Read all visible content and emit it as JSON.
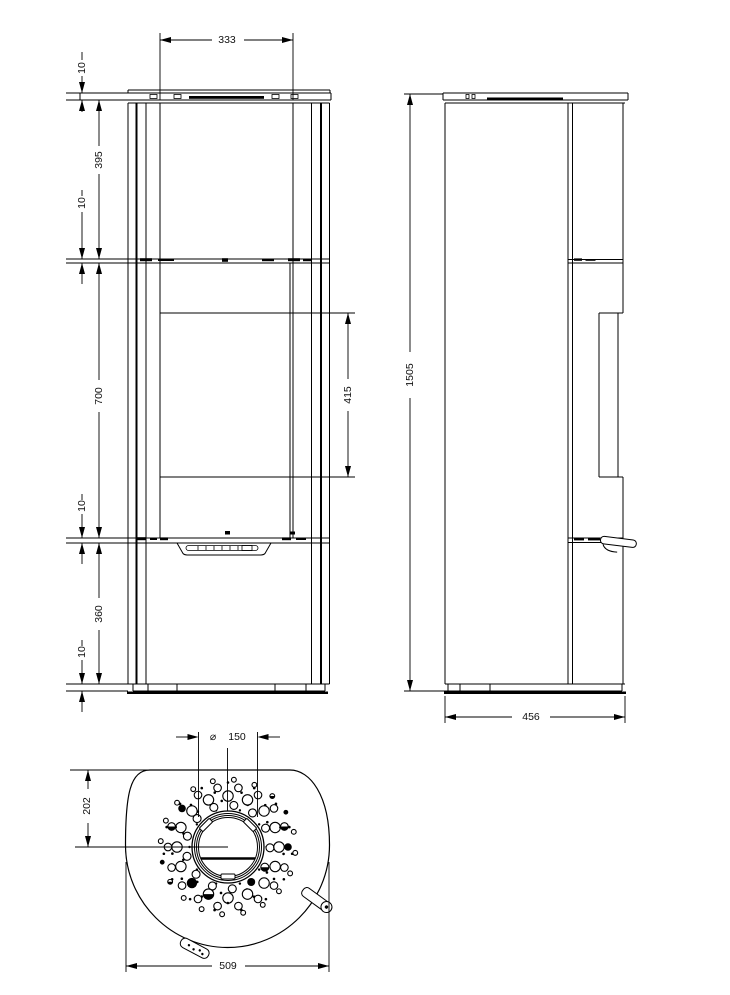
{
  "document": {
    "type": "technical drawing",
    "subject": "wood stove three-view dimensional drawing",
    "views": [
      "front view",
      "side view",
      "top view"
    ]
  },
  "dims": {
    "front": {
      "top_width": "333",
      "top_plate_thickness": "10",
      "upper_section_height": "395",
      "mid_plate_thickness": "10",
      "door_section_height": "700",
      "lower_plate_thickness": "10",
      "lower_section_height": "360",
      "base_plate_thickness": "10",
      "glass_height": "415"
    },
    "side": {
      "overall_height": "1505",
      "depth": "456"
    },
    "top": {
      "flue_symbol": "⌀",
      "flue_diameter": "150",
      "flue_center_from_back": "202",
      "overall_width": "509"
    }
  },
  "top_view": {
    "perforation_rings": [
      {
        "r": 38.5,
        "n": 10,
        "hole": 1.2,
        "a0": 18,
        "dots": true
      },
      {
        "r": 42,
        "n": 13,
        "hole": 4.0,
        "a0": 8
      },
      {
        "r": 46.5,
        "n": 11,
        "hole": 1.3,
        "a0": 25,
        "dots": true
      },
      {
        "r": 51,
        "n": 16,
        "hole": 5.2,
        "a0": 0
      },
      {
        "r": 56,
        "n": 13,
        "hole": 1.3,
        "a0": 14,
        "dots": true
      },
      {
        "r": 60,
        "n": 18,
        "hole": 3.8,
        "a0": 10
      },
      {
        "r": 64.5,
        "n": 15,
        "hole": 1.3,
        "a0": 0,
        "dots": true
      },
      {
        "r": 67.5,
        "n": 20,
        "hole": 2.4,
        "a0": 5
      }
    ]
  }
}
